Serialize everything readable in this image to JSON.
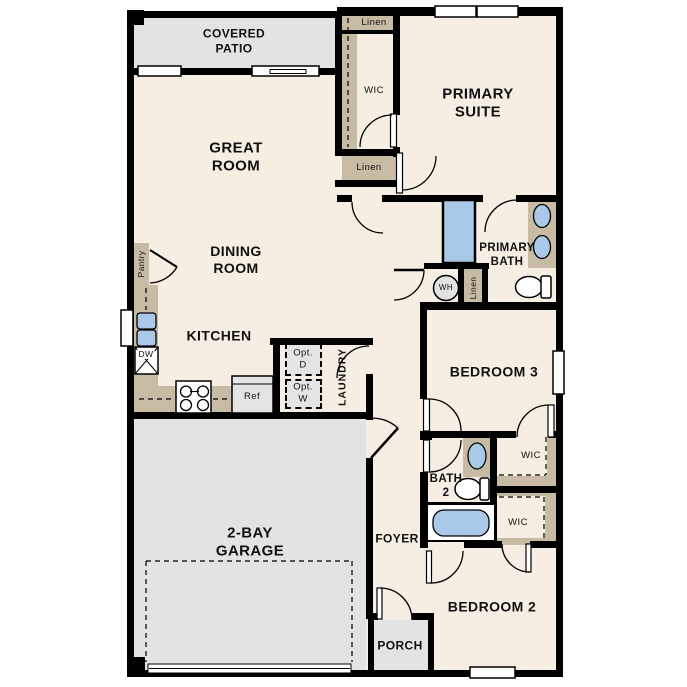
{
  "title": "Single-story floor plan",
  "colors": {
    "wall": "#000000",
    "floor": "#f6eee2",
    "outdoor_gray": "#e3e3e3",
    "cabinet_tan": "#c8bba4",
    "fixture_blue": "#aac9e8"
  },
  "rooms": {
    "covered_patio": "COVERED\nPATIO",
    "great_room": "GREAT\nROOM",
    "dining_room": "DINING\nROOM",
    "kitchen": "KITCHEN",
    "primary_suite": "PRIMARY\nSUITE",
    "primary_bath": "PRIMARY\nBATH",
    "bedroom_3": "BEDROOM 3",
    "bedroom_2": "BEDROOM 2",
    "garage": "2-BAY\nGARAGE",
    "foyer": "FOYER",
    "porch": "PORCH",
    "bath_2": "BATH\n2",
    "laundry": "LAUNDRY"
  },
  "closets": {
    "pantry": "Pantry",
    "linen_upper": "Linen",
    "linen_hall": "Linen",
    "linen_bath": "Linen",
    "wic_primary": "WIC",
    "wic_bedroom3": "WIC",
    "wic_bedroom2": "WIC"
  },
  "appliances": {
    "dishwasher": "DW",
    "refrigerator": "Ref",
    "water_heater": "WH",
    "opt_dryer": "Opt.\nD",
    "opt_washer": "Opt.\nW"
  }
}
